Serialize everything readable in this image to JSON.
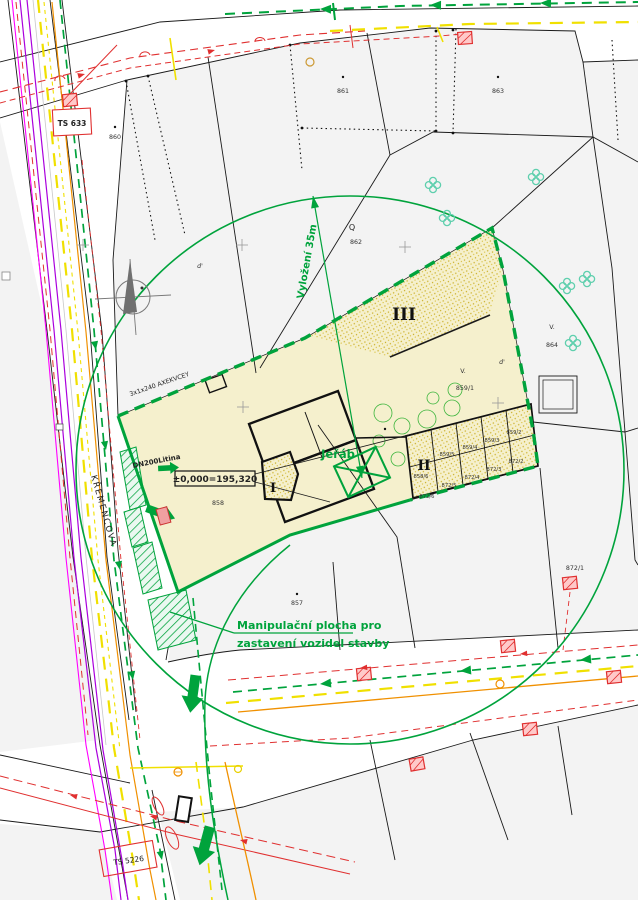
{
  "drawing": {
    "kind": "construction site plan over cadastral map",
    "labels": {
      "ts_top": "TS 633",
      "ts_bottom": "TS 5226",
      "street": "KŘEMENCOVA",
      "crane": "Jeřáb",
      "crane_radius": "Vyložení 35m",
      "level": "±0,000=195,320",
      "cable": "3x1x240 AXEKVCEY",
      "water": "DN200Litina",
      "staging1": "Manipulační plocha pro",
      "staging2": "zastavení vozidel stavby",
      "zone1": "I",
      "zone2": "II",
      "zone3": "III",
      "tree_q": "Q",
      "v1": "V.",
      "v2": "V.",
      "d1": "d'",
      "d2": "d'"
    },
    "parcels": {
      "p860": "860",
      "p861": "861",
      "p862": "862",
      "p863": "863",
      "p864": "864",
      "p857": "857",
      "p858": "858",
      "p859_1": "859/1",
      "p859_2": "859/2",
      "p859_3": "859/3",
      "p859_4": "859/4",
      "p859_5": "859/5",
      "p858_6": "858/6",
      "p872_1": "872/1",
      "p872_2": "872/2",
      "p872_3": "872/3",
      "p872_4": "872/4",
      "p872_5": "872/5",
      "p872_6": "872/6"
    },
    "colors": {
      "site_fill": "#f5f0cd",
      "stipple_dot": "#c9ad25",
      "boundary_green": "#00a33c",
      "utility_red": "#e03030",
      "utility_magenta": "#ff00ff",
      "utility_purple": "#aa00dd",
      "utility_yellow": "#f0e000",
      "utility_orange": "#f09000",
      "tree_cyan": "#5ecfad",
      "parcel_fill": "#f3f3f3",
      "line_black": "#1a1a1a"
    }
  }
}
